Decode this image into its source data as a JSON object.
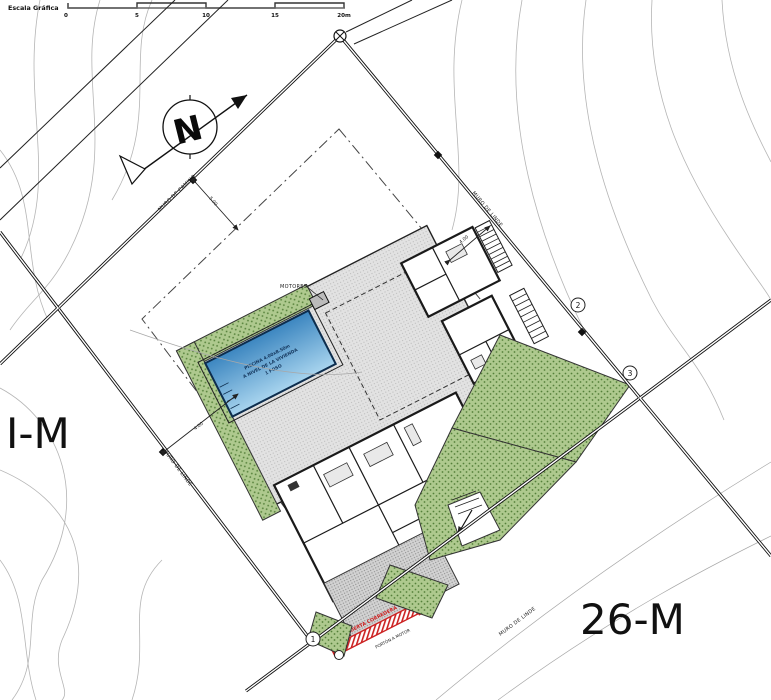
{
  "scale_bar": {
    "label": "Escala Gráfica",
    "ticks": [
      "0",
      "5",
      "10",
      "15",
      "20m"
    ]
  },
  "lot_labels": {
    "left": "I-M",
    "right": "26-M"
  },
  "boundary_labels": {
    "camino": "MURO DE CAMINO",
    "linde_left": "MURO DE LINDE",
    "linde_right": "MURO DE LINDE",
    "linde_bottom": "MURO DE LINDE"
  },
  "dimensions": {
    "d1": "5.00",
    "d2": "4.00",
    "d3": "4.00"
  },
  "markers": {
    "m1": "1",
    "m2": "2",
    "m3": "3"
  },
  "pool": {
    "line1": "PISCINA 4.00x8.50m",
    "line2": "A NIVEL DE LA VIVIENDA",
    "line3": "1 FOSO"
  },
  "equipment": {
    "motores": "MOTORES"
  },
  "gate": {
    "red_label": "PUERTA CORREDERA",
    "black_label": "PORTÓN A MOTOR"
  },
  "north_arrow": {
    "letter": "N"
  },
  "colors": {
    "pool_top": "#3c86c0",
    "pool_bottom": "#a8d4ee",
    "green_fill": "#aec98e",
    "green_dot": "#55803a",
    "building_fill": "#dcdcdc",
    "deck_fill": "#e2e2e2",
    "driveway_fill": "#d2d2d2",
    "accent_red": "#cc2222",
    "contour_gray": "#b5b5b5"
  }
}
